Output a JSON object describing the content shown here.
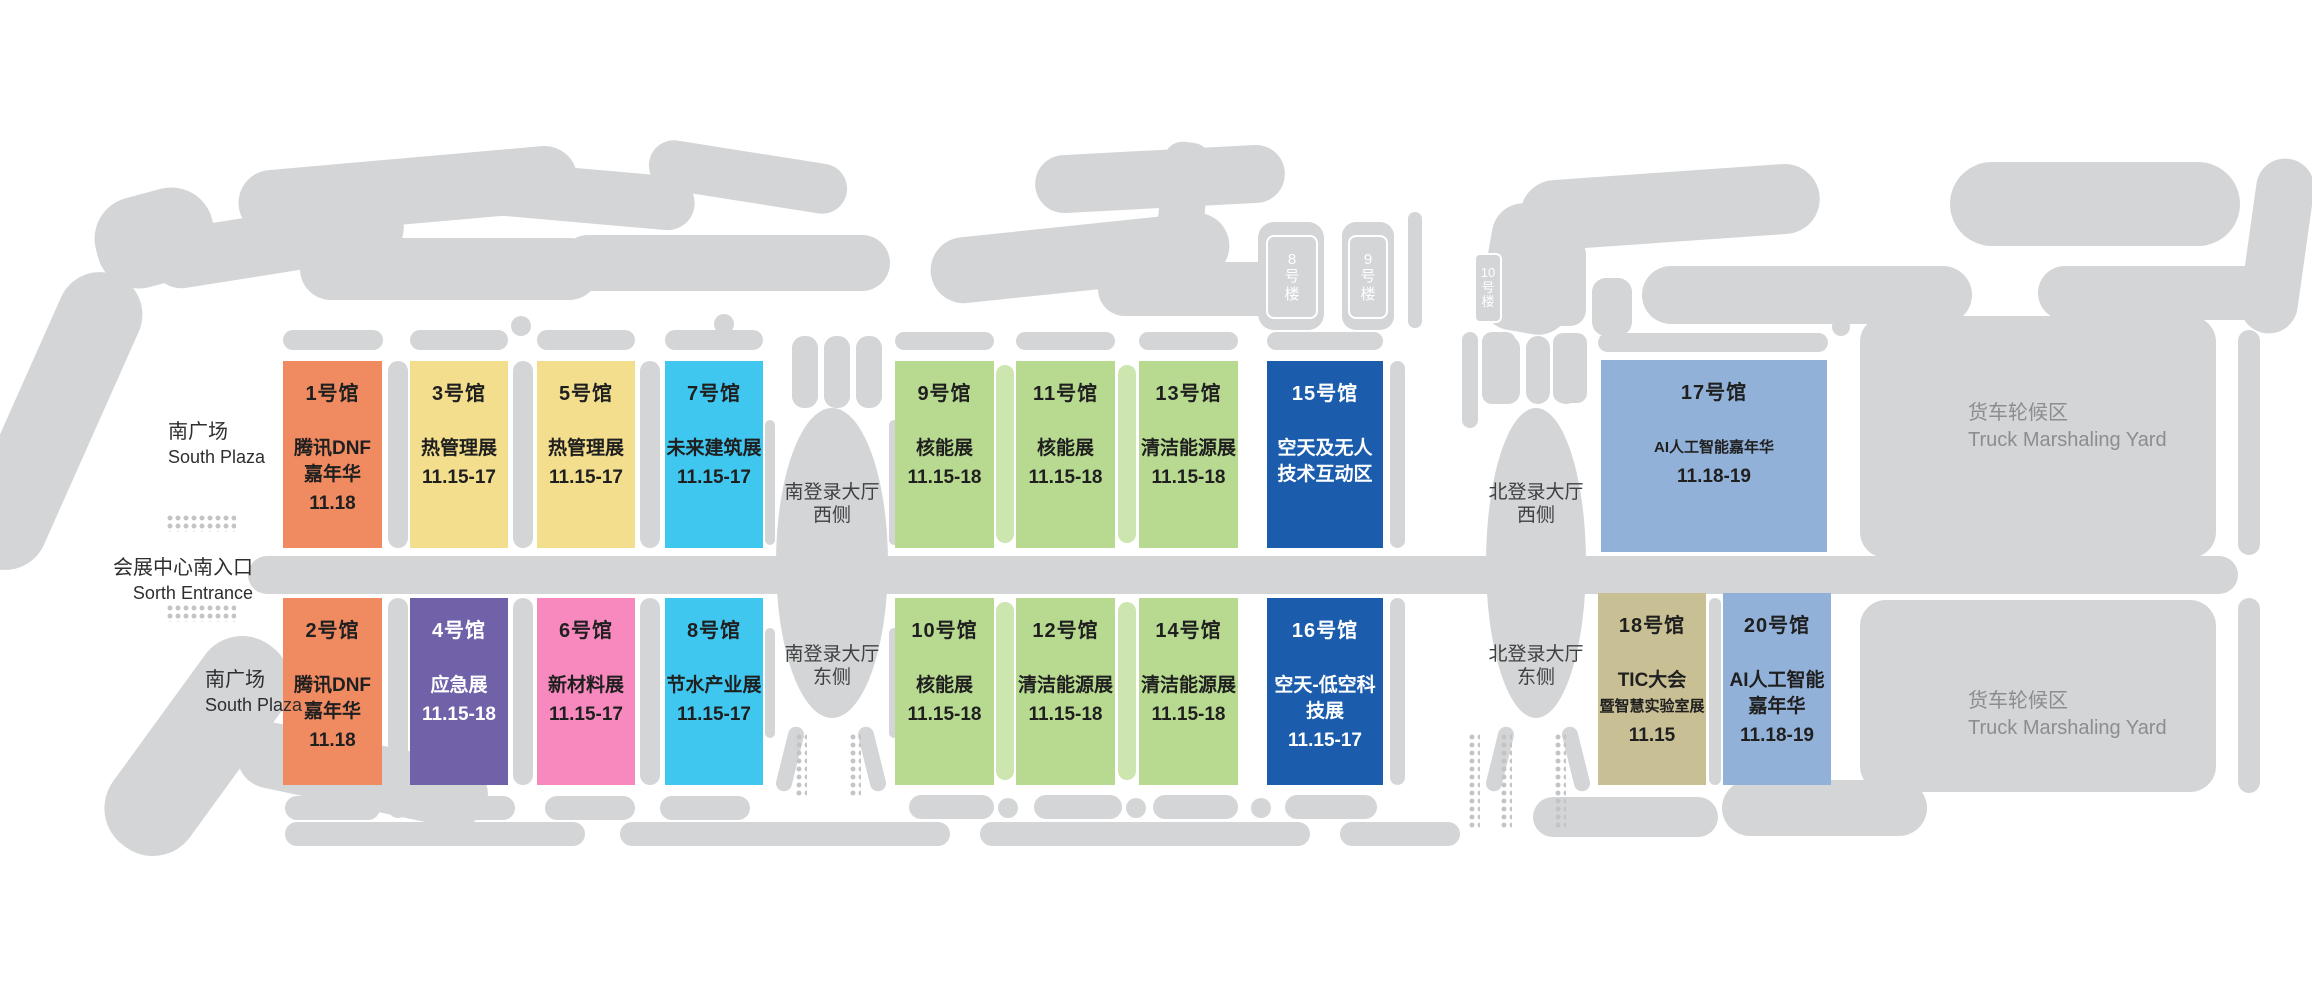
{
  "map_colors": {
    "ground_gray": "#d3d5d7",
    "dot_gray": "#c2c4c6",
    "connector_green": "#cde5ae",
    "orange": "#EF8A61",
    "yellow": "#F2DE8D",
    "cyan": "#3FC7F0",
    "purple": "#7061A8",
    "pink": "#F889BE",
    "green": "#B7DA90",
    "dark_blue": "#1B5CAC",
    "light_blue": "#92B1D8",
    "tan": "#C9BF94",
    "yard_text": "#8b8d90",
    "label_text": "#2e2e2e",
    "hall_text_dark": "#1f1f1f",
    "hall_text_light": "#ffffff"
  },
  "labels": {
    "south_plaza_top": {
      "zh": "南广场",
      "en": "South Plaza"
    },
    "south_entrance": {
      "zh": "会展中心南入口",
      "en": "Sorth Entrance"
    },
    "south_plaza_bottom": {
      "zh": "南广场",
      "en": "South Plaza"
    },
    "south_hall_west": {
      "line1": "南登录大厅",
      "line2": "西侧"
    },
    "south_hall_east": {
      "line1": "南登录大厅",
      "line2": "东侧"
    },
    "north_hall_west": {
      "line1": "北登录大厅",
      "line2": "西侧"
    },
    "north_hall_east": {
      "line1": "北登录大厅",
      "line2": "东侧"
    },
    "truck_yard": {
      "zh": "货车轮候区",
      "en": "Truck Marshaling Yard"
    }
  },
  "building_plates": [
    {
      "id": "building-8",
      "label": "8号楼",
      "lines": [
        "8",
        "号",
        "楼"
      ],
      "x": 1266,
      "y": 235,
      "w": 52,
      "h": 84,
      "small": false
    },
    {
      "id": "building-9",
      "label": "9号楼",
      "lines": [
        "9",
        "号",
        "楼"
      ],
      "x": 1348,
      "y": 235,
      "w": 40,
      "h": 84,
      "small": false
    },
    {
      "id": "building-10",
      "label": "10号楼",
      "lines": [
        "10",
        "号",
        "楼"
      ],
      "x": 1474,
      "y": 253,
      "w": 28,
      "h": 70,
      "small": true
    }
  ],
  "halls": [
    {
      "id": "1",
      "number": "1号馆",
      "name": [
        "腾讯DNF",
        "嘉年华"
      ],
      "dates": "11.18",
      "color": "#EF8A61",
      "text_color": "#1f1f1f",
      "x": 283,
      "y": 361,
      "w": 99,
      "h": 187
    },
    {
      "id": "3",
      "number": "3号馆",
      "name": [
        "热管理展"
      ],
      "dates": "11.15-17",
      "color": "#F2DE8D",
      "text_color": "#1f1f1f",
      "x": 410,
      "y": 361,
      "w": 98,
      "h": 187
    },
    {
      "id": "5",
      "number": "5号馆",
      "name": [
        "热管理展"
      ],
      "dates": "11.15-17",
      "color": "#F2DE8D",
      "text_color": "#1f1f1f",
      "x": 537,
      "y": 361,
      "w": 98,
      "h": 187
    },
    {
      "id": "7",
      "number": "7号馆",
      "name": [
        "未来建筑展"
      ],
      "dates": "11.15-17",
      "color": "#3FC7F0",
      "text_color": "#1f1f1f",
      "x": 665,
      "y": 361,
      "w": 98,
      "h": 187
    },
    {
      "id": "9",
      "number": "9号馆",
      "name": [
        "核能展"
      ],
      "dates": "11.15-18",
      "color": "#B7DA90",
      "text_color": "#1f1f1f",
      "x": 895,
      "y": 361,
      "w": 99,
      "h": 187
    },
    {
      "id": "11",
      "number": "11号馆",
      "name": [
        "核能展"
      ],
      "dates": "11.15-18",
      "color": "#B7DA90",
      "text_color": "#1f1f1f",
      "x": 1016,
      "y": 361,
      "w": 99,
      "h": 187
    },
    {
      "id": "13",
      "number": "13号馆",
      "name": [
        "清洁能源展"
      ],
      "dates": "11.15-18",
      "color": "#B7DA90",
      "text_color": "#1f1f1f",
      "x": 1139,
      "y": 361,
      "w": 99,
      "h": 187
    },
    {
      "id": "15",
      "number": "15号馆",
      "name": [
        "空天及无人",
        "技术互动区"
      ],
      "dates": "",
      "color": "#1B5CAC",
      "text_color": "#ffffff",
      "x": 1267,
      "y": 361,
      "w": 116,
      "h": 187
    },
    {
      "id": "17",
      "number": "17号馆",
      "name": [
        "AI人工智能嘉年华"
      ],
      "dates": "11.18-19",
      "color": "#92B1D8",
      "text_color": "#1f1f1f",
      "x": 1601,
      "y": 360,
      "w": 226,
      "h": 192
    },
    {
      "id": "2",
      "number": "2号馆",
      "name": [
        "腾讯DNF",
        "嘉年华"
      ],
      "dates": "11.18",
      "color": "#EF8A61",
      "text_color": "#1f1f1f",
      "x": 283,
      "y": 598,
      "w": 99,
      "h": 187
    },
    {
      "id": "4",
      "number": "4号馆",
      "name": [
        "应急展"
      ],
      "dates": "11.15-18",
      "color": "#7061A8",
      "text_color": "#ffffff",
      "x": 410,
      "y": 598,
      "w": 98,
      "h": 187
    },
    {
      "id": "6",
      "number": "6号馆",
      "name": [
        "新材料展"
      ],
      "dates": "11.15-17",
      "color": "#F889BE",
      "text_color": "#1f1f1f",
      "x": 537,
      "y": 598,
      "w": 98,
      "h": 187
    },
    {
      "id": "8",
      "number": "8号馆",
      "name": [
        "节水产业展"
      ],
      "dates": "11.15-17",
      "color": "#3FC7F0",
      "text_color": "#1f1f1f",
      "x": 665,
      "y": 598,
      "w": 98,
      "h": 187
    },
    {
      "id": "10",
      "number": "10号馆",
      "name": [
        "核能展"
      ],
      "dates": "11.15-18",
      "color": "#B7DA90",
      "text_color": "#1f1f1f",
      "x": 895,
      "y": 598,
      "w": 99,
      "h": 187
    },
    {
      "id": "12",
      "number": "12号馆",
      "name": [
        "清洁能源展"
      ],
      "dates": "11.15-18",
      "color": "#B7DA90",
      "text_color": "#1f1f1f",
      "x": 1016,
      "y": 598,
      "w": 99,
      "h": 187
    },
    {
      "id": "14",
      "number": "14号馆",
      "name": [
        "清洁能源展"
      ],
      "dates": "11.15-18",
      "color": "#B7DA90",
      "text_color": "#1f1f1f",
      "x": 1139,
      "y": 598,
      "w": 99,
      "h": 187
    },
    {
      "id": "16",
      "number": "16号馆",
      "name": [
        "空天-低空科",
        "技展"
      ],
      "dates": "11.15-17",
      "color": "#1B5CAC",
      "text_color": "#ffffff",
      "x": 1267,
      "y": 598,
      "w": 116,
      "h": 187
    },
    {
      "id": "18",
      "number": "18号馆",
      "name": [
        "TIC大会",
        "暨智慧实验室展"
      ],
      "dates": "11.15",
      "color": "#C9BF94",
      "text_color": "#1f1f1f",
      "x": 1598,
      "y": 593,
      "w": 108,
      "h": 192
    },
    {
      "id": "20",
      "number": "20号馆",
      "name": [
        "AI人工智能",
        "嘉年华"
      ],
      "dates": "11.18-19",
      "color": "#92B1D8",
      "text_color": "#1f1f1f",
      "x": 1723,
      "y": 593,
      "w": 108,
      "h": 192
    }
  ]
}
